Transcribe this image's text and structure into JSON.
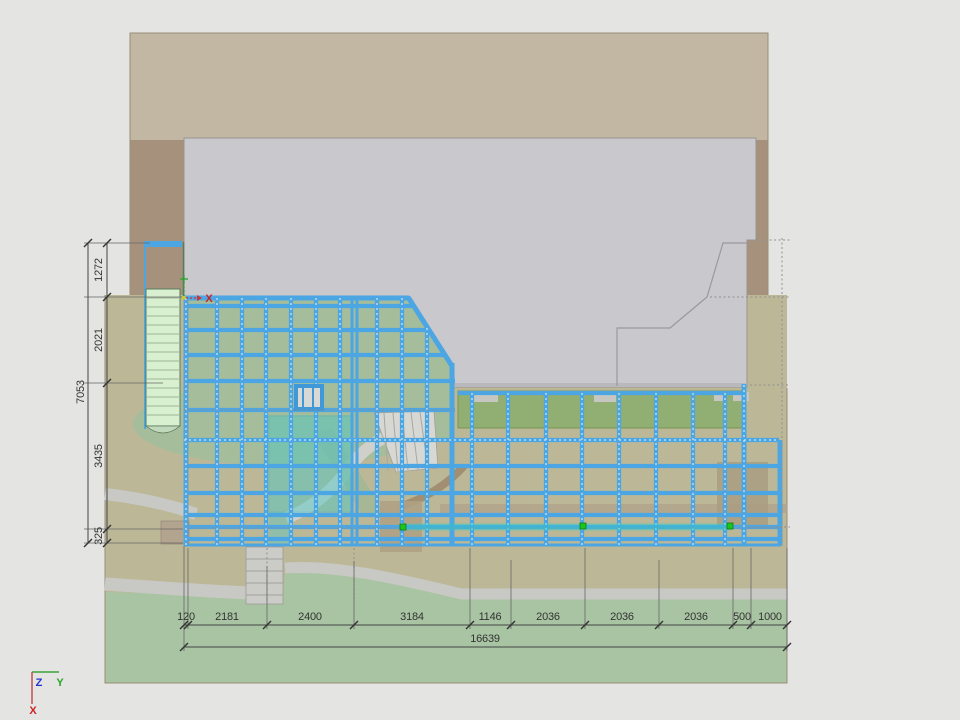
{
  "drawing": {
    "dims_bottom": {
      "segments": [
        "120",
        "2181",
        "2400",
        "3184",
        "1146",
        "2036",
        "2036",
        "2036",
        "500",
        "1000"
      ],
      "total": "16639"
    },
    "dims_left": {
      "segments": [
        "1272",
        "2021",
        "3435",
        "325"
      ],
      "total": "7053"
    },
    "ucs": {
      "z": "Z",
      "y": "Y",
      "x": "X"
    },
    "origin_axis_label": "X",
    "colors": {
      "background": "#e4e4e3",
      "terrain_upper_band": "#c2b7a2",
      "terrain_dark_strip": "#a6927c",
      "terrain_olive": "#bcb897",
      "lawn_green": "#a9c4a2",
      "under_deck_green": "#a6bd9b",
      "planting_bed_green": "#8fae72",
      "building_gray": "#c9c8cc",
      "deck_beam_blue": "#4ba6e3",
      "stair_light_green": "#d9f0d0",
      "selection_teal": "#3ec9c9",
      "grip_green": "#1ec41e",
      "dimension_text": "#333333"
    }
  }
}
